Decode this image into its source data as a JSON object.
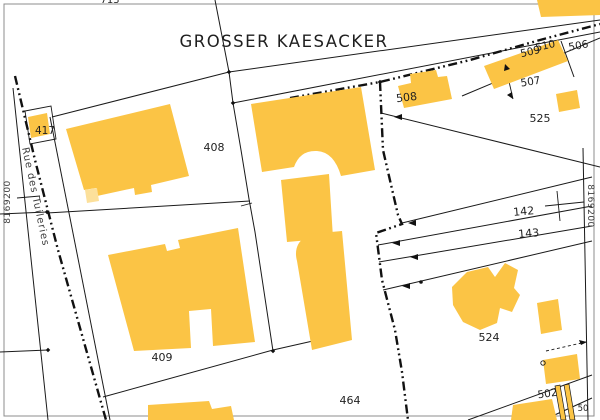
{
  "palette": {
    "background": "#FFFFFF",
    "building_fill": "#FBC445",
    "building_light_fill": "#FCE09B",
    "boundary_line": "#1A1A1A",
    "frame_line": "#8C8C8C",
    "label_text": "#1F1F1F"
  },
  "map": {
    "title": "GROSSER KAESACKER",
    "street_name": "Rue des Tuileries",
    "grid_coordinates": {
      "left": "8169200",
      "right": "8169200"
    },
    "parcel_labels": [
      {
        "text": "713",
        "x": 110,
        "y": 3,
        "rot": 0,
        "size": 10
      },
      {
        "text": "408",
        "x": 214,
        "y": 151,
        "rot": 0,
        "size": 11
      },
      {
        "text": "417",
        "x": 45,
        "y": 134,
        "rot": 0,
        "size": 10.5
      },
      {
        "text": "409",
        "x": 162,
        "y": 361,
        "rot": 0,
        "size": 11
      },
      {
        "text": "464",
        "x": 350,
        "y": 404,
        "rot": 0,
        "size": 11
      },
      {
        "text": "502",
        "x": 548,
        "y": 397,
        "rot": -8,
        "size": 10.5
      },
      {
        "text": "506",
        "x": 579,
        "y": 49,
        "rot": -10,
        "size": 10.5
      },
      {
        "text": "507",
        "x": 531,
        "y": 85,
        "rot": -9,
        "size": 10.5
      },
      {
        "text": "508",
        "x": 407,
        "y": 101,
        "rot": -7,
        "size": 11
      },
      {
        "text": "509",
        "x": 531,
        "y": 55,
        "rot": -13,
        "size": 10.5
      },
      {
        "text": "510",
        "x": 546,
        "y": 49,
        "rot": -13,
        "size": 10.5
      },
      {
        "text": "524",
        "x": 489,
        "y": 341,
        "rot": 0,
        "size": 11
      },
      {
        "text": "525",
        "x": 540,
        "y": 122,
        "rot": 0,
        "size": 11
      },
      {
        "text": "142",
        "x": 524,
        "y": 215,
        "rot": -5,
        "size": 11
      },
      {
        "text": "143",
        "x": 529,
        "y": 237,
        "rot": -5,
        "size": 11
      },
      {
        "text": "50",
        "x": 583,
        "y": 411,
        "rot": 0,
        "size": 8.5
      }
    ]
  }
}
